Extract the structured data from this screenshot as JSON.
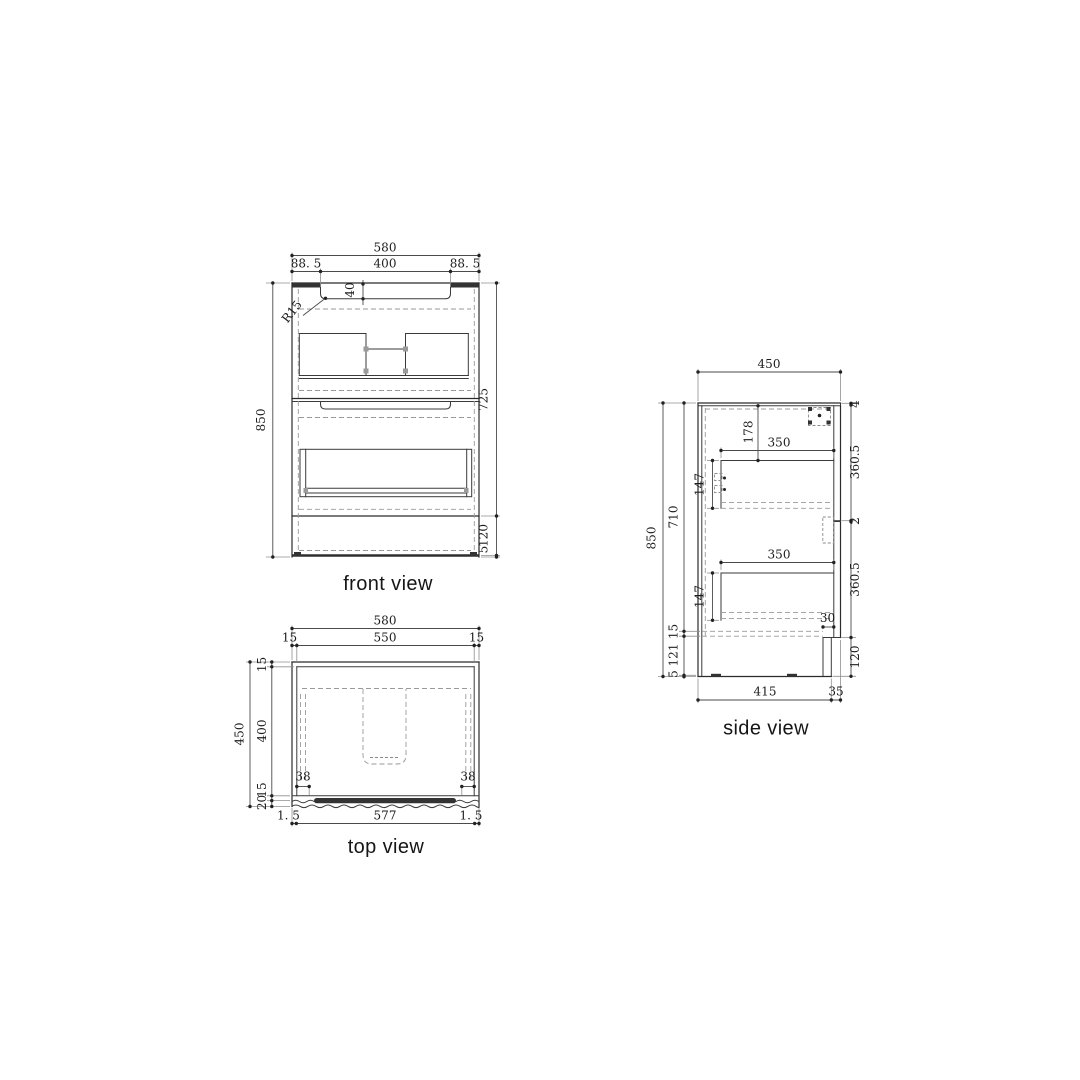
{
  "page": {
    "background": "#ffffff"
  },
  "palette": {
    "object_line": "#2b2b2b",
    "dashed_line": "#9a9a9a",
    "dimension_line": "#4a4a4a",
    "text": "#1c1c1c"
  },
  "views": {
    "front": {
      "label": "front view",
      "dims": {
        "overall_width": "580",
        "recess_offset_left": "88. 5",
        "recess_width": "400",
        "recess_offset_right": "88. 5",
        "recess_depth": "40",
        "recess_radius": "R15",
        "overall_height": "850",
        "body_height": "725",
        "plinth_height": "120",
        "floor_gap": "5"
      }
    },
    "top": {
      "label": "top view",
      "dims": {
        "overall_width": "580",
        "wall_left": "15",
        "inner_width": "550",
        "wall_right": "15",
        "overall_depth": "450",
        "wall_back": "15",
        "inner_depth": "400",
        "wall_front": "15",
        "front_lip": "20",
        "hinge_offset_left": "38",
        "hinge_offset_right": "38",
        "front_gap_left": "1. 5",
        "front_width": "577",
        "front_gap_right": "1. 5"
      }
    },
    "side": {
      "label": "side view",
      "dims": {
        "overall_depth": "450",
        "overall_height": "850",
        "interior_height": "710",
        "bottom_panel": "15",
        "plinth_height": "121",
        "floor_gap": "5",
        "top_thickness": "4",
        "drawer_front_upper": "360.5",
        "front_gap": "2",
        "drawer_front_lower": "360.5",
        "plinth_front": "120",
        "basin_drop": "178",
        "drawer_depth_upper": "350",
        "drawer_height_upper": "147",
        "drawer_depth_lower": "350",
        "drawer_height_lower": "147",
        "kick_recess": "30",
        "base_depth": "415",
        "front_offset": "35"
      }
    }
  }
}
